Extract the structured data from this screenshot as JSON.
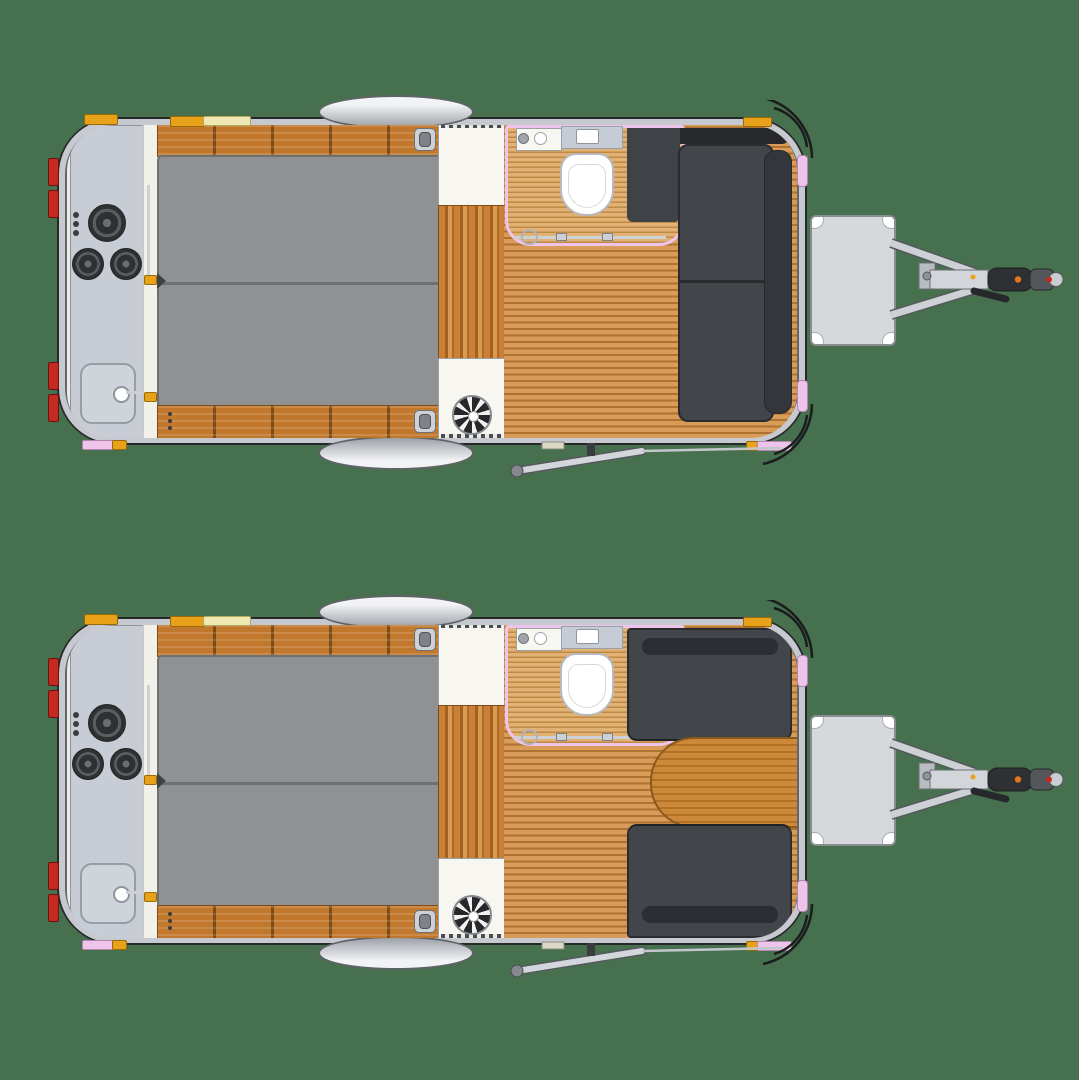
{
  "title": "Caravan floor plan – top view, two interior configurations",
  "colors": {
    "bg": "#47714E",
    "body_edge": "#27282A",
    "rim": "#C6CAD0",
    "wall_dark": "#63666B",
    "interior": "#EDECE4",
    "counter": "#C8CCD4",
    "counter_border": "#8F959D",
    "burner": "#2E3032",
    "burner_ring": "#5A5E63",
    "bed": "#8F9193",
    "bed_line": "#6E7073",
    "wood": "#C1772C",
    "wood_sep": "#7C4B16",
    "floor_light": "#D89B58",
    "floor_dark": "#AE7231",
    "bathfloor_light": "#E2B274",
    "bathfloor_dark": "#BE8A45",
    "cab_white": "#F7F6F1",
    "cab_border": "#9BA0A7",
    "sofa": "#42454A",
    "sofa_dark": "#33363A",
    "sofa_deep": "#26282B",
    "sofa_border": "#2A2C2F",
    "table_light": "#CD893A",
    "table_dark": "#B37127",
    "table_border": "#8A5A1D",
    "pink": "#EFC4EA",
    "amber": "#E8A21A",
    "pale": "#EFE8B2",
    "red": "#C22A22",
    "silver": "#CDD1D6",
    "silver_dark": "#55585C",
    "box": "#D6D9DC",
    "box_border": "#898C90"
  },
  "plans": [
    {
      "id": "plan-a",
      "position": "top",
      "view": "top-down",
      "layout": "front-lounge-sofa",
      "galley": {
        "cooktop_burners": 3,
        "control_knobs": 3,
        "sink": 1,
        "faucet": 1
      },
      "bed": {
        "mattress_panels": 2
      },
      "storage": {
        "rear_overhead_lockers": 2,
        "wardrobe": 1,
        "upper_cabinet": 1,
        "lower_cabinet_with_fan": 1,
        "locker_latches": 2
      },
      "bathroom": {
        "shower_enclosure": 1,
        "toilet": 1,
        "vanity_sink": 1,
        "counter_shelf": 1,
        "sliding_door": 1
      },
      "lounge": {
        "type": "L-shaped sofa",
        "seat_cushions": 2,
        "backrest_sections": 2,
        "corner_seat": 1
      },
      "chassis": {
        "wheel_fenders": 2,
        "a_frame_drawbar": 1,
        "drawbar_storage_box": 1,
        "hitch_coupler": 1,
        "handbrake_lever": 1,
        "entry_step": 1,
        "tail_lights": 4,
        "side_markers_amber": 6,
        "side_markers_pink": 6
      }
    },
    {
      "id": "plan-b",
      "position": "bottom",
      "view": "top-down",
      "layout": "front-dinette-with-table",
      "galley": {
        "cooktop_burners": 3,
        "control_knobs": 3,
        "sink": 1,
        "faucet": 1
      },
      "bed": {
        "mattress_panels": 2
      },
      "storage": {
        "rear_overhead_lockers": 2,
        "wardrobe": 1,
        "upper_cabinet": 1,
        "lower_cabinet_with_fan": 1,
        "locker_latches": 2
      },
      "bathroom": {
        "shower_enclosure": 1,
        "toilet": 1,
        "vanity_sink": 1,
        "counter_shelf": 1,
        "sliding_door": 1
      },
      "lounge": {
        "type": "facing dinette benches",
        "bench_seats": 2,
        "backrest_sections": 2,
        "dining_table": 1
      },
      "chassis": {
        "wheel_fenders": 2,
        "a_frame_drawbar": 1,
        "drawbar_storage_box": 1,
        "hitch_coupler": 1,
        "handbrake_lever": 1,
        "entry_step": 1,
        "tail_lights": 4,
        "side_markers_amber": 6,
        "side_markers_pink": 6
      }
    }
  ]
}
